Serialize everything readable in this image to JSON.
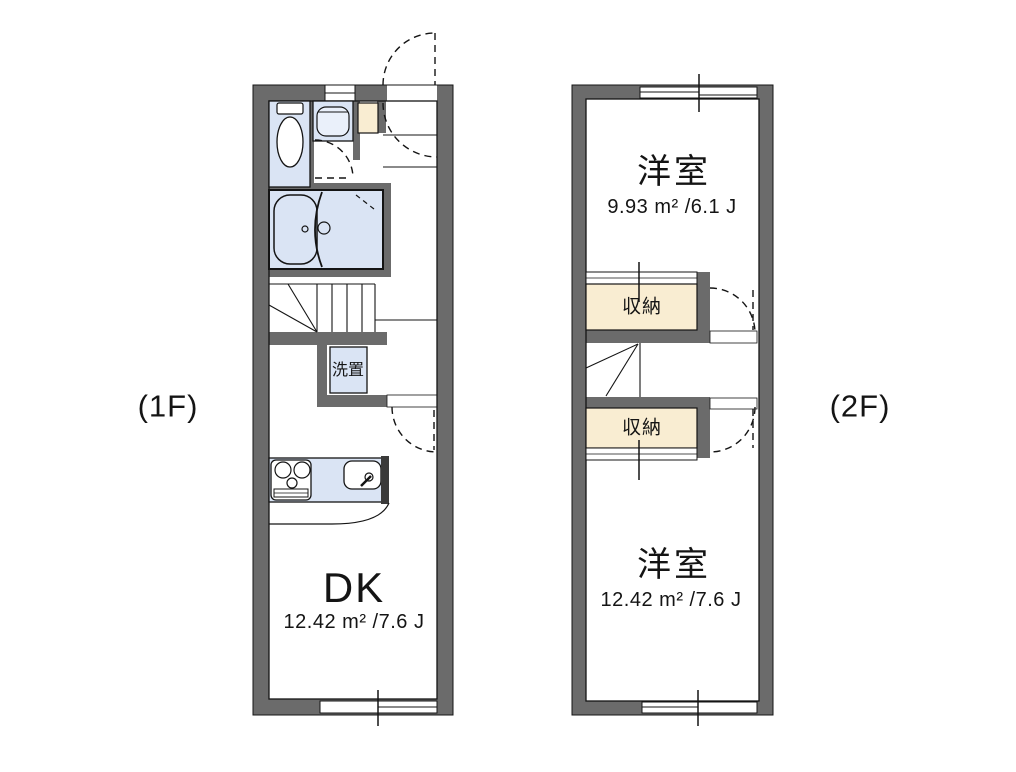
{
  "floor_1": {
    "label": "(1F)",
    "rooms": {
      "dk": {
        "name": "DK",
        "area": "12.42 m² /7.6 J"
      },
      "laundry": {
        "name": "洗置"
      }
    }
  },
  "floor_2": {
    "label": "(2F)",
    "rooms": {
      "bedroom_upper": {
        "name": "洋室",
        "area": "9.93 m² /6.1 J"
      },
      "closet_upper": {
        "name": "収納"
      },
      "closet_lower": {
        "name": "収納"
      },
      "bedroom_lower": {
        "name": "洋室",
        "area": "12.42 m² /7.6 J"
      }
    }
  },
  "colors": {
    "wall": "#6b6b6b",
    "fixture_fill": "#dae4f4",
    "closet_fill": "#f9edd2",
    "outline": "#141414",
    "background": "#ffffff"
  }
}
